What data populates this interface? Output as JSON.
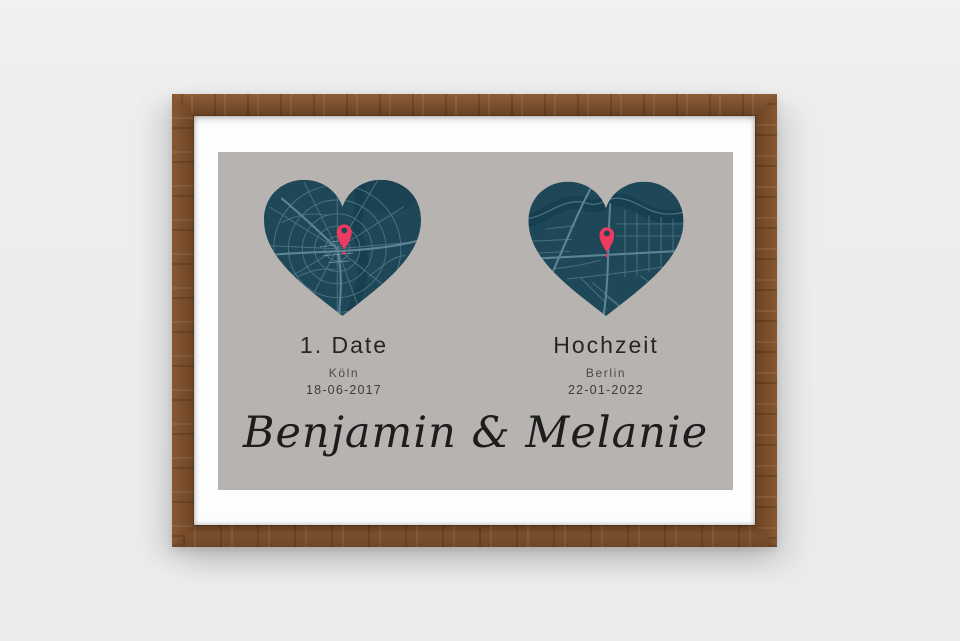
{
  "poster": {
    "left_event": {
      "title": "1. Date",
      "city": "Köln",
      "date": "18-06-2017"
    },
    "right_event": {
      "title": "Hochzeit",
      "city": "Berlin",
      "date": "22-01-2022"
    },
    "couple_names": "Benjamin & Melanie"
  },
  "icons": {
    "left_map_pin": "location-pin",
    "right_map_pin": "location-pin"
  },
  "colors": {
    "pin_accent": "#ed3a5e",
    "map_base": "#1e4757",
    "map_street": "#4c7282",
    "map_water": "#16404f",
    "poster_background": "#b7b3b1",
    "mat": "#fdfdfe",
    "frame_wood": "#7b4f2c",
    "page_background": "#ededee"
  }
}
